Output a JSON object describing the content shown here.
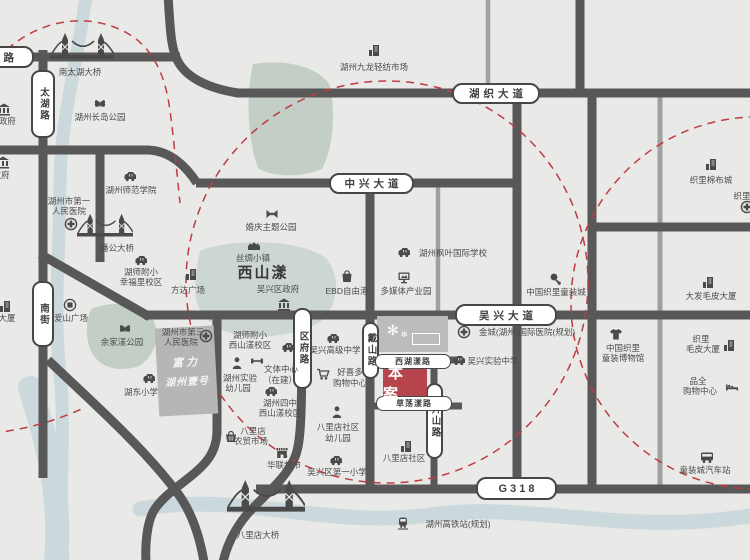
{
  "canvas": {
    "w": 750,
    "h": 560,
    "bg": "#e9e9e7"
  },
  "palette": {
    "road": "#585858",
    "road_light": "#a0a0a0",
    "water": "#ccd9dc",
    "park": "#c3cec6",
    "lake": "#ccd6d3",
    "dash": "#bf3c40",
    "site": "#b5444c",
    "ink": "#4c4c4c"
  },
  "water": [
    {
      "d": "M 86 -4 C 78 60 60 120 60 185 C 60 250 53 310 60 375 C 66 425 58 495 63 562",
      "w": 13
    },
    {
      "d": "M 140 509 C 235 491 330 529 430 515 C 530 501 625 537 756 515",
      "w": 15
    },
    {
      "d": "M 30 388 C 46 438 62 492 56 562",
      "w": 24
    }
  ],
  "parks": [
    {
      "kind": "park",
      "d": "M 253 64 C 292 58 322 70 330 86 C 337 120 331 152 322 169 C 299 179 269 176 258 168 C 247 138 246 94 253 64 Z"
    },
    {
      "kind": "lake",
      "d": "M 201 250 C 243 237 302 241 326 258 C 341 276 338 302 324 319 C 298 338 249 341 222 330 C 199 318 192 299 196 278 C 197 267 197 258 201 250 Z"
    },
    {
      "kind": "park",
      "d": "M 91 309 C 116 299 142 305 153 319 C 161 336 155 356 139 366 C 119 373 99 368 91 351 C 85 337 86 321 91 309 Z"
    }
  ],
  "roads_light": [
    {
      "d": "M 438 186 L 438 314",
      "w": 4.5
    },
    {
      "d": "M 660 94 L 660 488",
      "w": 5
    },
    {
      "d": "M 488 -4 L 488 92",
      "w": 4.5
    }
  ],
  "roads": [
    {
      "d": "M -6 57 L 180 57",
      "w": 9
    },
    {
      "d": "M 168 -6 C 170 28 171 46 176 57 C 183 76 206 88 238 93",
      "w": 9
    },
    {
      "d": "M 236 93 L 756 93",
      "w": 9
    },
    {
      "d": "M 43 50 L 43 478",
      "w": 9
    },
    {
      "d": "M -6 150 L 148 150 C 172 151 187 168 197 183",
      "w": 9
    },
    {
      "d": "M 196 183 L 517 183",
      "w": 9
    },
    {
      "d": "M 100 146 L 100 262",
      "w": 9
    },
    {
      "d": "M 40 254 L 150 317",
      "w": 9
    },
    {
      "d": "M 144 315 L 756 315",
      "w": 9
    },
    {
      "d": "M 517 91 L 517 489",
      "w": 9
    },
    {
      "d": "M 580 -6 L 580 95",
      "w": 9
    },
    {
      "d": "M 592 91 L 592 489",
      "w": 9
    },
    {
      "d": "M 592 227 L 756 227",
      "w": 9
    },
    {
      "d": "M 370 184 L 370 489",
      "w": 9
    },
    {
      "d": "M 302 313 C 302 418 301 443 295 457 C 287 477 268 492 252 509 C 240 521 228 540 223 562",
      "w": 9
    },
    {
      "d": "M 217 314 L 217 430 C 217 452 206 464 191 476 C 175 489 161 498 153 512 C 147 524 145 544 146 562",
      "w": 9
    },
    {
      "d": "M 48 360 C 92 402 142 446 176 491 C 190 509 199 532 204 562",
      "w": 9
    },
    {
      "d": "M 256 489 L 756 489",
      "w": 9
    },
    {
      "d": "M 368 360 L 462 360",
      "w": 7
    },
    {
      "d": "M 368 406 L 462 406",
      "w": 7
    },
    {
      "d": "M 434 356 L 434 490",
      "w": 7
    }
  ],
  "dashed": {
    "circles": [
      {
        "cx": 387,
        "cy": 282,
        "r": 201
      },
      {
        "cx": 757,
        "cy": 303,
        "r": 186
      }
    ],
    "arcs": [
      "M -12 70 C 24 22 82 8 127 33 C 152 47 164 73 169 104 C 173 130 176 165 180 203",
      "M -8 433 C 24 430 56 421 86 407"
    ]
  },
  "road_labels": [
    {
      "t": "路",
      "x": -60,
      "y": 46,
      "w": 94,
      "h": 22,
      "cls": "h end"
    },
    {
      "t": "太湖路",
      "x": 31,
      "y": 70,
      "w": 24,
      "h": 68,
      "cls": "v"
    },
    {
      "t": "南街",
      "x": 32,
      "y": 281,
      "w": 22,
      "h": 66,
      "cls": "v"
    },
    {
      "t": "湖织大道",
      "x": 452,
      "y": 83,
      "w": 88,
      "h": 21,
      "cls": "h"
    },
    {
      "t": "中兴大道",
      "x": 329,
      "y": 173,
      "w": 85,
      "h": 21,
      "cls": "h"
    },
    {
      "t": "吴兴大道",
      "x": 455,
      "y": 304,
      "w": 102,
      "h": 22,
      "cls": "h"
    },
    {
      "t": "G318",
      "x": 476,
      "y": 477,
      "w": 81,
      "h": 23,
      "cls": "g"
    },
    {
      "t": "区府路",
      "x": 293,
      "y": 308,
      "w": 19,
      "h": 81,
      "cls": "v"
    },
    {
      "t": "戴山路",
      "x": 362,
      "y": 322,
      "w": 17,
      "h": 57,
      "cls": "v"
    },
    {
      "t": "升山路",
      "x": 426,
      "y": 383,
      "w": 17,
      "h": 76,
      "cls": "v"
    },
    {
      "t": "西湖漾路",
      "x": 375,
      "y": 354,
      "w": 76,
      "h": 15,
      "cls": "small"
    },
    {
      "t": "草荡漾路",
      "x": 376,
      "y": 396,
      "w": 76,
      "h": 15,
      "cls": "small"
    }
  ],
  "site": {
    "label": "本案",
    "x": 383,
    "y": 369,
    "w": 44,
    "h": 27
  },
  "logo_box": {
    "x": 377,
    "y": 316,
    "w": 71,
    "h": 36,
    "deco1": "✻",
    "deco2": "✼"
  },
  "parcel": {
    "x": 157,
    "y": 327,
    "w": 59,
    "h": 88,
    "rotate": -3,
    "line1": "富力",
    "line2": "湖州壹号"
  },
  "markers": [
    {
      "name": "nantaihu-bridge",
      "icon": {
        "n": "bridge",
        "x": 82,
        "y": 47,
        "w": 64,
        "h": 34
      },
      "texts": [
        {
          "t": "南太湖大桥",
          "x": 80,
          "y": 72
        }
      ]
    },
    {
      "name": "city-government",
      "icon": {
        "n": "bank",
        "x": 4,
        "y": 109
      },
      "texts": [
        {
          "t": "市政府",
          "x": 3,
          "y": 121
        }
      ]
    },
    {
      "name": "government-2",
      "icon": {
        "n": "bank",
        "x": 3,
        "y": 162
      },
      "texts": [
        {
          "t": "政府",
          "x": 1,
          "y": 175
        }
      ]
    },
    {
      "name": "changdao-park",
      "icon": {
        "n": "butterfly",
        "x": 100,
        "y": 104
      },
      "texts": [
        {
          "t": "湖州长岛公园",
          "x": 100,
          "y": 117
        }
      ]
    },
    {
      "name": "huzhou-normal-college",
      "icon": {
        "n": "school",
        "x": 130,
        "y": 176
      },
      "texts": [
        {
          "t": "湖州师范学院",
          "x": 131,
          "y": 190
        }
      ]
    },
    {
      "name": "first-peoples-hospital",
      "icon": {
        "n": "cross",
        "x": 71,
        "y": 224
      },
      "texts": [
        {
          "t": "湖州市第一",
          "x": 69,
          "y": 201
        },
        {
          "t": "人民医院",
          "x": 69,
          "y": 211
        }
      ]
    },
    {
      "name": "pangong-bridge",
      "icon": {
        "n": "bridge",
        "x": 105,
        "y": 226,
        "w": 56,
        "h": 30
      },
      "texts": [
        {
          "t": "潘公大桥",
          "x": 117,
          "y": 248
        }
      ]
    },
    {
      "name": "hushifuxiao-xingfuli",
      "icon": {
        "n": "school",
        "x": 141,
        "y": 260
      },
      "texts": [
        {
          "t": "湖师附小",
          "x": 141,
          "y": 272
        },
        {
          "t": "幸福里校区",
          "x": 141,
          "y": 282
        }
      ]
    },
    {
      "name": "fangda-plaza",
      "icon": {
        "n": "building",
        "x": 191,
        "y": 274
      },
      "texts": [
        {
          "t": "方达广场",
          "x": 188,
          "y": 290
        }
      ]
    },
    {
      "name": "aishan-plaza",
      "icon": {
        "n": "plaza",
        "x": 70,
        "y": 305
      },
      "texts": [
        {
          "t": "爱山广场",
          "x": 71,
          "y": 318
        }
      ]
    },
    {
      "name": "yujiayang-park",
      "icon": {
        "n": "butterfly",
        "x": 125,
        "y": 329
      },
      "texts": [
        {
          "t": "余家漾公园",
          "x": 122,
          "y": 342
        }
      ]
    },
    {
      "name": "hudong-primary-school",
      "icon": {
        "n": "school",
        "x": 149,
        "y": 378
      },
      "texts": [
        {
          "t": "湖东小学",
          "x": 141,
          "y": 392
        }
      ]
    },
    {
      "name": "tower-building",
      "icon": {
        "n": "building",
        "x": 5,
        "y": 306
      },
      "texts": [
        {
          "t": "大厦",
          "x": 7,
          "y": 318
        }
      ]
    },
    {
      "name": "third-peoples-hospital",
      "icon": {
        "n": "cross",
        "x": 206,
        "y": 336
      },
      "texts": [
        {
          "t": "湖州市第三",
          "x": 183,
          "y": 332
        },
        {
          "t": "人民医院",
          "x": 181,
          "y": 342
        }
      ]
    },
    {
      "name": "wedding-theme-park",
      "icon": {
        "n": "bowtie",
        "x": 272,
        "y": 214
      },
      "texts": [
        {
          "t": "婚庆主题公园",
          "x": 271,
          "y": 227
        }
      ]
    },
    {
      "name": "silk-town",
      "icon": {
        "n": "houses",
        "x": 254,
        "y": 244
      },
      "texts": [
        {
          "t": "丝绸小镇",
          "x": 253,
          "y": 258
        }
      ]
    },
    {
      "name": "xishanyang-lake-label",
      "texts": [
        {
          "t": "西山漾",
          "x": 263,
          "y": 272,
          "big": true
        }
      ]
    },
    {
      "name": "wuxing-district-government",
      "icon": {
        "n": "bank",
        "x": 284,
        "y": 304
      },
      "texts": [
        {
          "t": "吴兴区政府",
          "x": 278,
          "y": 289
        }
      ]
    },
    {
      "name": "ebd-freeport",
      "icon": {
        "n": "bag",
        "x": 347,
        "y": 276
      },
      "texts": [
        {
          "t": "EBD自由港",
          "x": 347,
          "y": 291
        }
      ]
    },
    {
      "name": "multimedia-industry-park",
      "icon": {
        "n": "screen",
        "x": 404,
        "y": 277
      },
      "texts": [
        {
          "t": "多媒体产业园",
          "x": 406,
          "y": 291
        }
      ]
    },
    {
      "name": "maple-leaf-intl-school",
      "icon": {
        "n": "school",
        "x": 404,
        "y": 252
      },
      "texts": [
        {
          "t": "湖州枫叶国际学校",
          "x": 453,
          "y": 253
        }
      ]
    },
    {
      "name": "jiulong-textile-market",
      "icon": {
        "n": "building",
        "x": 374,
        "y": 50
      },
      "texts": [
        {
          "t": "湖州九龙轻纺市场",
          "x": 374,
          "y": 67
        }
      ]
    },
    {
      "name": "jincheng-intl-hospital",
      "icon": {
        "n": "cross",
        "x": 464,
        "y": 332
      },
      "texts": [
        {
          "t": "金城(湖州)国际医院(规划)",
          "x": 527,
          "y": 332
        }
      ]
    },
    {
      "name": "wuxing-experimental-school",
      "icon": {
        "n": "school",
        "x": 459,
        "y": 360
      },
      "texts": [
        {
          "t": "吴兴实验中学",
          "x": 493,
          "y": 361
        }
      ]
    },
    {
      "name": "wuxing-senior-high",
      "icon": {
        "n": "school",
        "x": 333,
        "y": 338
      },
      "texts": [
        {
          "t": "吴兴高级中学",
          "x": 335,
          "y": 350
        }
      ]
    },
    {
      "name": "haoxiduo-mall",
      "icon": {
        "n": "cart",
        "x": 323,
        "y": 374
      },
      "texts": [
        {
          "t": "好喜多",
          "x": 350,
          "y": 372
        },
        {
          "t": "购物中心",
          "x": 350,
          "y": 383
        }
      ]
    },
    {
      "name": "hushifuxiao-xishanyang",
      "icon": {
        "n": "school",
        "x": 288,
        "y": 347
      },
      "texts": [
        {
          "t": "湖师附小",
          "x": 250,
          "y": 335
        },
        {
          "t": "西山漾校区",
          "x": 250,
          "y": 345
        }
      ]
    },
    {
      "name": "sports-center",
      "icon": {
        "n": "barbell",
        "x": 257,
        "y": 361
      },
      "texts": [
        {
          "t": "文体中心",
          "x": 281,
          "y": 369
        },
        {
          "t": "（在建）",
          "x": 280,
          "y": 380
        }
      ]
    },
    {
      "name": "huzhou-experimental-kindergarten",
      "icon": {
        "n": "person",
        "x": 237,
        "y": 363
      },
      "texts": [
        {
          "t": "湖州实验",
          "x": 240,
          "y": 378
        },
        {
          "t": "幼儿园",
          "x": 238,
          "y": 388
        }
      ]
    },
    {
      "name": "huzhou-no4-xishanyang",
      "icon": {
        "n": "school",
        "x": 271,
        "y": 391
      },
      "texts": [
        {
          "t": "湖州四中",
          "x": 280,
          "y": 403
        },
        {
          "t": "西山漾校区",
          "x": 280,
          "y": 413
        }
      ]
    },
    {
      "name": "balidian-farmers-market",
      "icon": {
        "n": "basket",
        "x": 231,
        "y": 436
      },
      "texts": [
        {
          "t": "八里店",
          "x": 253,
          "y": 431
        },
        {
          "t": "农贸市场",
          "x": 251,
          "y": 441
        }
      ]
    },
    {
      "name": "hualian-supermarket",
      "icon": {
        "n": "store",
        "x": 282,
        "y": 452
      },
      "texts": [
        {
          "t": "华联超市",
          "x": 284,
          "y": 465
        }
      ]
    },
    {
      "name": "balidian-community-kindergarten",
      "icon": {
        "n": "person",
        "x": 337,
        "y": 412
      },
      "texts": [
        {
          "t": "八里店社区",
          "x": 338,
          "y": 427
        },
        {
          "t": "幼儿园",
          "x": 338,
          "y": 438
        }
      ]
    },
    {
      "name": "wuxing-first-primary",
      "icon": {
        "n": "school",
        "x": 336,
        "y": 460
      },
      "texts": [
        {
          "t": "吴兴区第一小学",
          "x": 337,
          "y": 472
        }
      ]
    },
    {
      "name": "balidian-community",
      "icon": {
        "n": "building",
        "x": 406,
        "y": 446
      },
      "texts": [
        {
          "t": "八里店社区",
          "x": 404,
          "y": 458
        }
      ]
    },
    {
      "name": "balidian-bridge",
      "icon": {
        "n": "bridge",
        "x": 266,
        "y": 497,
        "w": 78,
        "h": 42
      },
      "texts": [
        {
          "t": "八里店大桥",
          "x": 258,
          "y": 535
        }
      ]
    },
    {
      "name": "hsr-station-planned",
      "icon": {
        "n": "train",
        "x": 403,
        "y": 523
      },
      "texts": [
        {
          "t": "湖州高铁站(规划)",
          "x": 458,
          "y": 524
        }
      ]
    },
    {
      "name": "zhili-childrenswear-city",
      "icon": {
        "n": "baby",
        "x": 555,
        "y": 279
      },
      "texts": [
        {
          "t": "中国织里童装城",
          "x": 556,
          "y": 292
        }
      ]
    },
    {
      "name": "zhili-cotton-city",
      "icon": {
        "n": "building",
        "x": 711,
        "y": 164
      },
      "texts": [
        {
          "t": "织里棉布城",
          "x": 711,
          "y": 180
        }
      ]
    },
    {
      "name": "zhili-partial",
      "icon": {
        "n": "cross",
        "x": 747,
        "y": 207
      },
      "texts": [
        {
          "t": "织里",
          "x": 742,
          "y": 196
        }
      ]
    },
    {
      "name": "dafa-fur-building",
      "icon": {
        "n": "building",
        "x": 708,
        "y": 282
      },
      "texts": [
        {
          "t": "大发毛皮大厦",
          "x": 711,
          "y": 296
        }
      ]
    },
    {
      "name": "childrenswear-museum",
      "icon": {
        "n": "tshirt",
        "x": 616,
        "y": 334
      },
      "texts": [
        {
          "t": "中国织里",
          "x": 623,
          "y": 348
        },
        {
          "t": "童装博物馆",
          "x": 623,
          "y": 358
        }
      ]
    },
    {
      "name": "zhili-fur-building",
      "icon": {
        "n": "building",
        "x": 729,
        "y": 345
      },
      "texts": [
        {
          "t": "织里",
          "x": 701,
          "y": 339
        },
        {
          "t": "毛皮大厦",
          "x": 703,
          "y": 349
        }
      ]
    },
    {
      "name": "pinquan-mall",
      "icon": {
        "n": "bed",
        "x": 732,
        "y": 387
      },
      "texts": [
        {
          "t": "品全",
          "x": 698,
          "y": 381
        },
        {
          "t": "购物中心",
          "x": 700,
          "y": 391
        }
      ]
    },
    {
      "name": "childrenswear-bus-station",
      "icon": {
        "n": "bus",
        "x": 707,
        "y": 457
      },
      "texts": [
        {
          "t": "童装城汽车站",
          "x": 705,
          "y": 470
        }
      ]
    }
  ]
}
